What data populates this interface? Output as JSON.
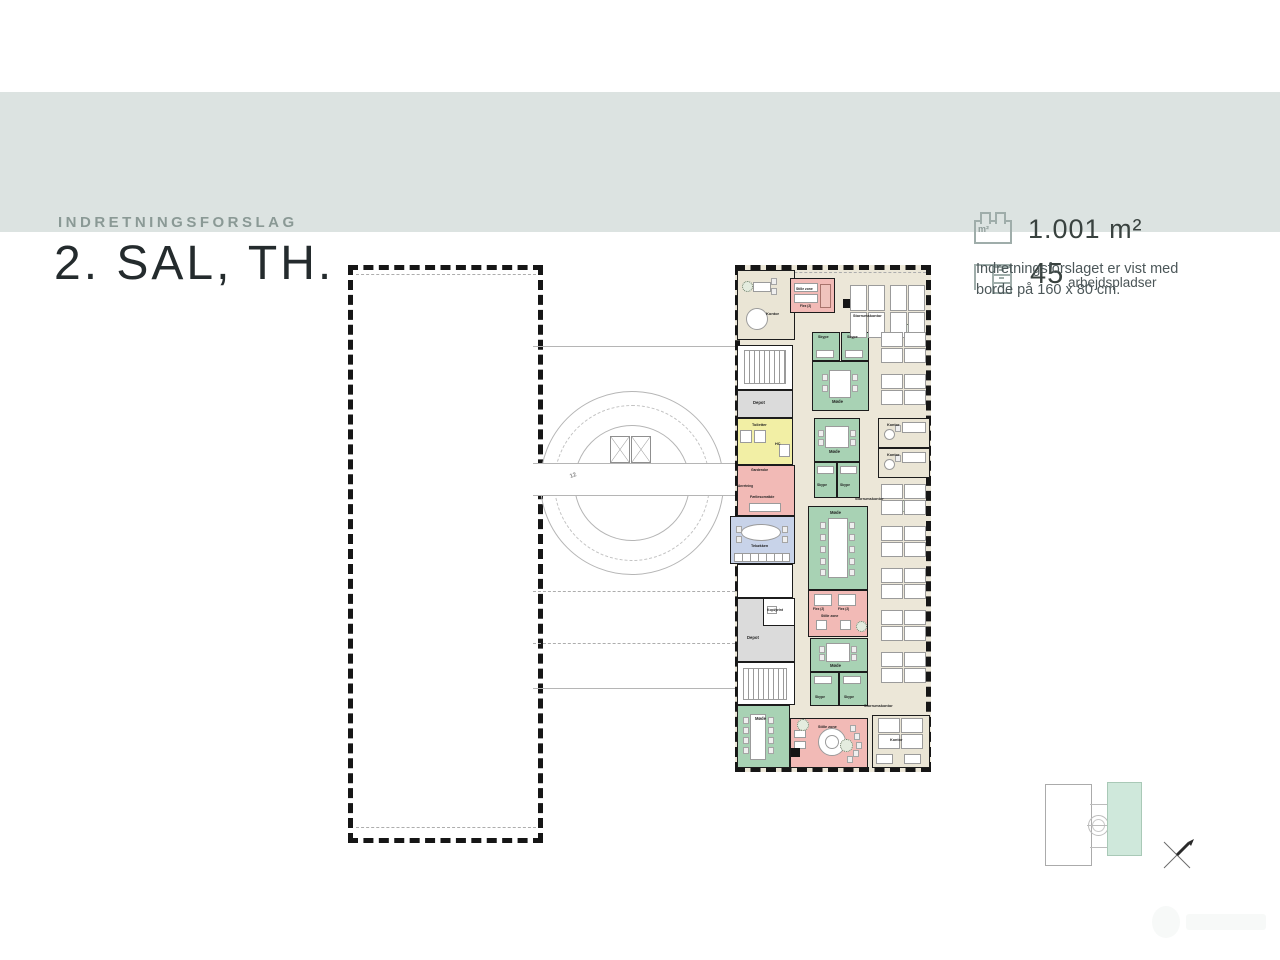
{
  "theme": {
    "band": "#dce3e1",
    "title_color": "#242b2d",
    "eyebrow_color": "#8a9995",
    "icon_color": "#9fadaa",
    "room_green": "#a8d2b4",
    "room_pink": "#f2bab6",
    "room_yellow": "#f2efa5",
    "room_blue": "#c8d3e9",
    "room_gray": "#dbdbdb",
    "open_office_beige": "#ece7d8",
    "keyplan_highlight": "#cfe8db"
  },
  "header": {
    "eyebrow": "INDRETNINGSFORSLAG",
    "title": "2. SAL, TH."
  },
  "stats": {
    "area": {
      "icon": "area-plan-icon",
      "value": "1.001 m²",
      "unit_label": "m²"
    },
    "workplaces": {
      "icon": "desk-icon",
      "value": "45",
      "suffix": "arbejdspladser"
    }
  },
  "note": {
    "text": "Indretningsforslaget er vist med borde på 160 x 80 cm."
  },
  "plan": {
    "rooms": [
      {
        "n": "kontor-exec",
        "x": 389,
        "y": 12,
        "w": 58,
        "h": 70,
        "bg": "#eae5d5"
      },
      {
        "n": "stille-zone-top",
        "x": 442,
        "y": 20,
        "w": 45,
        "h": 35,
        "bg": "#f2bab6"
      },
      {
        "n": "skype-a1",
        "x": 464,
        "y": 74,
        "w": 28,
        "h": 29,
        "bg": "#a8d2b4"
      },
      {
        "n": "skype-a2",
        "x": 493,
        "y": 74,
        "w": 28,
        "h": 29,
        "bg": "#a8d2b4"
      },
      {
        "n": "mode-a",
        "x": 464,
        "y": 103,
        "w": 57,
        "h": 50,
        "bg": "#a8d2b4"
      },
      {
        "n": "mode-b",
        "x": 466,
        "y": 160,
        "w": 46,
        "h": 44,
        "bg": "#a8d2b4"
      },
      {
        "n": "skype-b1",
        "x": 466,
        "y": 204,
        "w": 23,
        "h": 36,
        "bg": "#a8d2b4"
      },
      {
        "n": "skype-b2",
        "x": 489,
        "y": 204,
        "w": 23,
        "h": 36,
        "bg": "#a8d2b4"
      },
      {
        "n": "mode-c",
        "x": 460,
        "y": 248,
        "w": 60,
        "h": 84,
        "bg": "#a8d2b4"
      },
      {
        "n": "stille-zone-mid",
        "x": 460,
        "y": 332,
        "w": 60,
        "h": 47,
        "bg": "#f2bab6"
      },
      {
        "n": "mode-d",
        "x": 462,
        "y": 380,
        "w": 58,
        "h": 34,
        "bg": "#a8d2b4"
      },
      {
        "n": "skype-d1",
        "x": 462,
        "y": 414,
        "w": 29,
        "h": 34,
        "bg": "#a8d2b4"
      },
      {
        "n": "skype-d2",
        "x": 491,
        "y": 414,
        "w": 29,
        "h": 34,
        "bg": "#a8d2b4"
      },
      {
        "n": "stair-room-top",
        "x": 389,
        "y": 87,
        "w": 56,
        "h": 45,
        "bg": "#ffffff"
      },
      {
        "n": "depot-1",
        "x": 389,
        "y": 132,
        "w": 56,
        "h": 28,
        "bg": "#dbdbdb"
      },
      {
        "n": "toiletter",
        "x": 389,
        "y": 160,
        "w": 56,
        "h": 47,
        "bg": "#f2efa5"
      },
      {
        "n": "faellesomraade",
        "x": 389,
        "y": 207,
        "w": 58,
        "h": 51,
        "bg": "#f2bab6"
      },
      {
        "n": "tekokken",
        "x": 382,
        "y": 258,
        "w": 65,
        "h": 48,
        "bg": "#c8d3e9"
      },
      {
        "n": "void-room",
        "x": 389,
        "y": 306,
        "w": 56,
        "h": 34,
        "bg": "#ffffff"
      },
      {
        "n": "depot-2",
        "x": 389,
        "y": 340,
        "w": 58,
        "h": 64,
        "bg": "#dbdbdb"
      },
      {
        "n": "kopi-print",
        "x": 415,
        "y": 340,
        "w": 32,
        "h": 28,
        "bg": "#ffffff"
      },
      {
        "n": "stair-room-bottom",
        "x": 389,
        "y": 404,
        "w": 58,
        "h": 43,
        "bg": "#ffffff"
      },
      {
        "n": "kontor-r1",
        "x": 530,
        "y": 160,
        "w": 52,
        "h": 30,
        "bg": "#eae5d5"
      },
      {
        "n": "kontor-r2",
        "x": 530,
        "y": 190,
        "w": 52,
        "h": 30,
        "bg": "#eae5d5"
      },
      {
        "n": "mode-bottom",
        "x": 389,
        "y": 447,
        "w": 53,
        "h": 63,
        "bg": "#a8d2b4"
      },
      {
        "n": "stille-zone-bottom",
        "x": 442,
        "y": 460,
        "w": 78,
        "h": 50,
        "bg": "#f2bab6"
      },
      {
        "n": "kontor-bottom",
        "x": 524,
        "y": 457,
        "w": 58,
        "h": 53,
        "bg": "#eae5d5"
      }
    ],
    "core": [
      [
        "ring",
        192,
        133,
        184
      ],
      [
        "ringd",
        206,
        147,
        156
      ],
      [
        "ring",
        226,
        167,
        116
      ],
      [
        "line",
        185,
        88,
        202
      ],
      [
        "line",
        185,
        430,
        202
      ],
      [
        "dline",
        185,
        333,
        202
      ],
      [
        "dline",
        185,
        385,
        202
      ],
      [
        "dline",
        8,
        16,
        180
      ],
      [
        "dline",
        8,
        569,
        180
      ],
      [
        "dline",
        392,
        14,
        186
      ],
      [
        "corridor",
        185,
        205,
        202,
        33
      ],
      [
        "xbox",
        262,
        178,
        20,
        27
      ],
      [
        "xbox",
        283,
        178,
        20,
        27
      ]
    ],
    "furniture": [
      [
        "rect",
        405,
        24,
        18,
        10
      ],
      [
        "chair",
        423,
        20
      ],
      [
        "chair",
        423,
        30
      ],
      [
        "circle",
        398,
        50,
        22
      ],
      [
        "plant",
        394,
        23,
        11
      ],
      [
        "rect",
        446,
        25,
        24,
        9
      ],
      [
        "rect",
        446,
        36,
        24,
        9
      ],
      [
        "sofa",
        472,
        26,
        11,
        24
      ],
      [
        "fill",
        495,
        41,
        9,
        9
      ],
      [
        "rect",
        468,
        92,
        18,
        8
      ],
      [
        "rect",
        497,
        92,
        18,
        8
      ],
      [
        "rect",
        481,
        112,
        22,
        28
      ],
      [
        "chair",
        474,
        116
      ],
      [
        "chair",
        474,
        127
      ],
      [
        "chair",
        504,
        116
      ],
      [
        "chair",
        504,
        127
      ],
      [
        "rect",
        477,
        168,
        24,
        22
      ],
      [
        "chair",
        470,
        172
      ],
      [
        "chair",
        470,
        181
      ],
      [
        "chair",
        502,
        172
      ],
      [
        "chair",
        502,
        181
      ],
      [
        "rect",
        469,
        208,
        17,
        8
      ],
      [
        "rect",
        492,
        208,
        17,
        8
      ],
      [
        "rect",
        480,
        260,
        20,
        60
      ],
      [
        "chair",
        472,
        264
      ],
      [
        "chair",
        472,
        276
      ],
      [
        "chair",
        472,
        288
      ],
      [
        "chair",
        472,
        300
      ],
      [
        "chair",
        472,
        311
      ],
      [
        "chair",
        501,
        264
      ],
      [
        "chair",
        501,
        276
      ],
      [
        "chair",
        501,
        288
      ],
      [
        "chair",
        501,
        300
      ],
      [
        "chair",
        501,
        311
      ],
      [
        "rect",
        466,
        336,
        18,
        12
      ],
      [
        "rect",
        490,
        336,
        18,
        12
      ],
      [
        "rect",
        468,
        362,
        11,
        10
      ],
      [
        "rect",
        492,
        362,
        11,
        10
      ],
      [
        "plant",
        508,
        363,
        11
      ],
      [
        "rect",
        478,
        385,
        24,
        19
      ],
      [
        "chair",
        471,
        388
      ],
      [
        "chair",
        471,
        396
      ],
      [
        "chair",
        503,
        388
      ],
      [
        "chair",
        503,
        396
      ],
      [
        "rect",
        466,
        418,
        18,
        8
      ],
      [
        "rect",
        495,
        418,
        18,
        8
      ],
      [
        "stairs",
        396,
        92,
        42,
        34
      ],
      [
        "stairs",
        395,
        410,
        44,
        32
      ],
      [
        "rect",
        392,
        172,
        12,
        13
      ],
      [
        "rect",
        406,
        172,
        12,
        13
      ],
      [
        "rect",
        431,
        186,
        11,
        13
      ],
      [
        "rect",
        401,
        245,
        32,
        9
      ],
      [
        "oval",
        393,
        266,
        40,
        17
      ],
      [
        "counter",
        386,
        295,
        56,
        9
      ],
      [
        "chair",
        388,
        268
      ],
      [
        "chair",
        388,
        278
      ],
      [
        "chair",
        434,
        268
      ],
      [
        "chair",
        434,
        278
      ],
      [
        "rect",
        419,
        348,
        10,
        8
      ],
      [
        "rect",
        554,
        164,
        24,
        11
      ],
      [
        "chair",
        547,
        167
      ],
      [
        "circle",
        536,
        171,
        11
      ],
      [
        "rect",
        554,
        194,
        24,
        11
      ],
      [
        "chair",
        547,
        197
      ],
      [
        "circle",
        536,
        201,
        11
      ],
      [
        "plant",
        549,
        242,
        12
      ],
      [
        "rect",
        402,
        456,
        16,
        46
      ],
      [
        "chair",
        395,
        459
      ],
      [
        "chair",
        395,
        469
      ],
      [
        "chair",
        395,
        479
      ],
      [
        "chair",
        395,
        489
      ],
      [
        "chair",
        420,
        459
      ],
      [
        "chair",
        420,
        469
      ],
      [
        "chair",
        420,
        479
      ],
      [
        "chair",
        420,
        489
      ],
      [
        "circle",
        470,
        470,
        28
      ],
      [
        "circle",
        477,
        477,
        14
      ],
      [
        "rect",
        446,
        472,
        12,
        8
      ],
      [
        "rect",
        446,
        483,
        12,
        8
      ],
      [
        "chair",
        502,
        467
      ],
      [
        "chair",
        506,
        475
      ],
      [
        "chair",
        508,
        484
      ],
      [
        "chair",
        505,
        492
      ],
      [
        "chair",
        499,
        498
      ],
      [
        "fill",
        443,
        490,
        9,
        9
      ],
      [
        "plant",
        449,
        461,
        12
      ],
      [
        "rect",
        528,
        496,
        17,
        10
      ],
      [
        "rect",
        556,
        496,
        17,
        10
      ],
      [
        "plant",
        553,
        66,
        13
      ],
      [
        "plant",
        492,
        481,
        13
      ]
    ],
    "clusters": [
      [
        "v",
        502,
        27
      ],
      [
        "v",
        542,
        27
      ],
      [
        "h",
        533,
        74
      ],
      [
        "h",
        533,
        116
      ],
      [
        "h",
        533,
        226
      ],
      [
        "h",
        533,
        268
      ],
      [
        "h",
        533,
        310
      ],
      [
        "h",
        533,
        352
      ],
      [
        "h",
        533,
        394
      ],
      [
        "h",
        530,
        460
      ]
    ],
    "labels": [
      [
        "Kontor",
        418,
        54,
        4
      ],
      [
        "Stille zone",
        448,
        30,
        3.4
      ],
      [
        "Flex (2)",
        452,
        47,
        3.2
      ],
      [
        "Storrumskontor",
        505,
        57,
        3.8
      ],
      [
        "Skype",
        470,
        78,
        3.6
      ],
      [
        "Skype",
        499,
        78,
        3.6
      ],
      [
        "Møde",
        484,
        142,
        4.2
      ],
      [
        "Møde",
        481,
        192,
        4.2
      ],
      [
        "Skype",
        469,
        226,
        3.4
      ],
      [
        "Skype",
        492,
        226,
        3.4
      ],
      [
        "Møde",
        482,
        253,
        4.2
      ],
      [
        "Storrumskontor",
        507,
        240,
        3.8
      ],
      [
        "Flex (2)",
        465,
        350,
        3.2
      ],
      [
        "Flex (2)",
        490,
        350,
        3.2
      ],
      [
        "Stille zone",
        473,
        357,
        3.5
      ],
      [
        "Møde",
        482,
        406,
        4.2
      ],
      [
        "Skype",
        467,
        438,
        3.4
      ],
      [
        "Skype",
        496,
        438,
        3.4
      ],
      [
        "Depot",
        405,
        143,
        4.2
      ],
      [
        "Toiletter",
        404,
        166,
        3.8
      ],
      [
        "HC",
        427,
        185,
        3.8
      ],
      [
        "Garderobe",
        403,
        211,
        3.4
      ],
      [
        "Anretning",
        390,
        227,
        3.2
      ],
      [
        "Fællesområde",
        402,
        238,
        3.6
      ],
      [
        "Tekøkken",
        403,
        287,
        3.8
      ],
      [
        "Kopi/print",
        419,
        351,
        3.4
      ],
      [
        "Depot",
        399,
        378,
        4.2
      ],
      [
        "Kontor",
        539,
        166,
        3.8
      ],
      [
        "Kontor",
        539,
        196,
        3.8
      ],
      [
        "Møde",
        407,
        459,
        4.2
      ],
      [
        "Stille zone",
        470,
        468,
        3.8
      ],
      [
        "Kontor",
        542,
        481,
        3.8
      ],
      [
        "Storrumskontor",
        516,
        447,
        3.8
      ],
      [
        "12",
        222,
        215,
        6,
        -20,
        "#8e8e8e"
      ]
    ]
  },
  "keyplan": {
    "highlighted_wing": "right"
  }
}
